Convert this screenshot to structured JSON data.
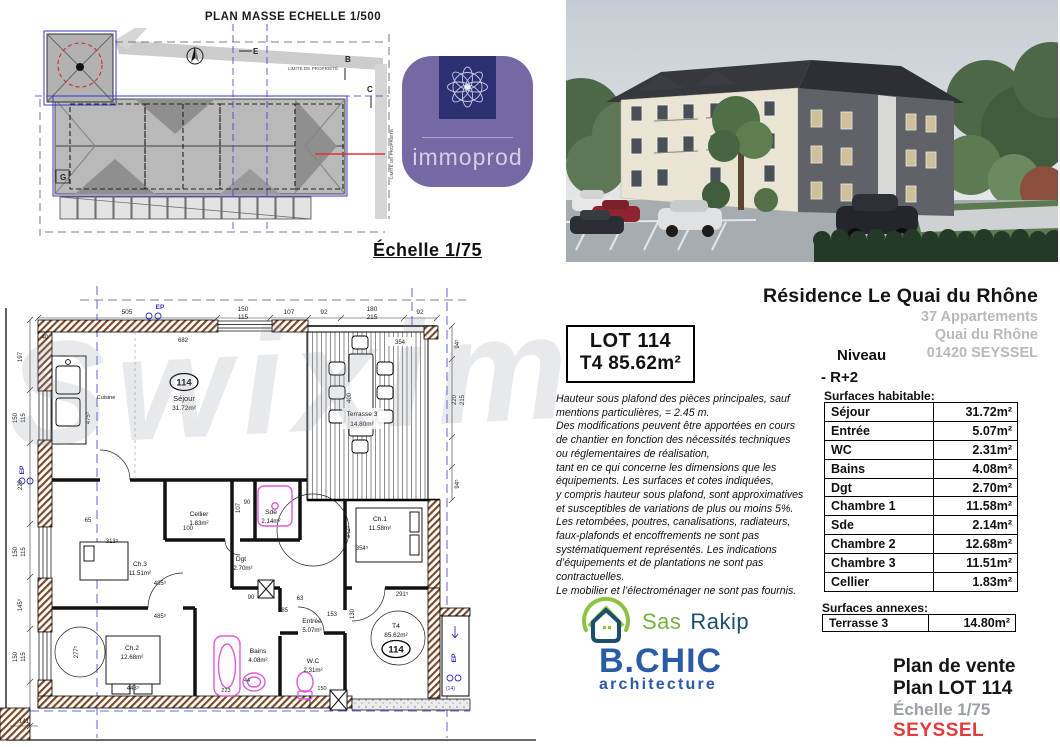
{
  "watermark": "Swixim",
  "site_plan": {
    "title": "PLAN MASSE ECHELLE 1/500",
    "limite_label_1": "LIMITE DE PROPRIÉTÉ",
    "limite_label_2": "LIMITE DE PROPRIÉTÉ",
    "marker_g": "G",
    "marker_e": "E",
    "marker_b": "B",
    "marker_c": "C"
  },
  "scale_label": "Échelle 1/75",
  "immoprod": {
    "name": "immoprod"
  },
  "header": {
    "title": "Résidence Le Quai du Rhône",
    "line1": "37 Appartements",
    "line2": "Quai du Rhône",
    "line3": "01420 SEYSSEL",
    "niveau_label": "Niveau",
    "niveau_value": "- R+2"
  },
  "lot_box": {
    "line1": "LOT 114",
    "line2": "T4 85.62m²"
  },
  "disclaimer": [
    "Hauteur sous plafond des pièces principales, sauf",
    "mentions particulières, = 2.45 m.",
    "Des modifications peuvent être apportées en cours",
    "de chantier en fonction des nécessités techniques",
    "ou réglementaires de réalisation,",
    "tant en ce qui concerne les dimensions que les",
    "équipements. Les surfaces et cotes indiquées,",
    "y compris hauteur sous plafond, sont approximatives",
    "et susceptibles de variations de plus ou moins 5%.",
    "Les retombées, poutres, canalisations, radiateurs,",
    "faux-plafonds et encoffrements ne sont pas",
    "systématiquement représentés. Les indications",
    "d’équipements et de plantations ne sont pas contractuelles.",
    "Le mobilier et l’électroménager ne sont pas fournis."
  ],
  "surfaces_habitable": {
    "label": "Surfaces habitable:",
    "rows": [
      {
        "name": "Séjour",
        "value": "31.72m²"
      },
      {
        "name": "Entrée",
        "value": "5.07m²"
      },
      {
        "name": "WC",
        "value": "2.31m²"
      },
      {
        "name": "Bains",
        "value": "4.08m²"
      },
      {
        "name": "Dgt",
        "value": "2.70m²"
      },
      {
        "name": "Chambre 1",
        "value": "11.58m²"
      },
      {
        "name": "Sde",
        "value": "2.14m²"
      },
      {
        "name": "Chambre 2",
        "value": "12.68m²"
      },
      {
        "name": "Chambre 3",
        "value": "11.51m²"
      },
      {
        "name": "Cellier",
        "value": "1.83m²"
      }
    ]
  },
  "surfaces_annexes": {
    "label": "Surfaces annexes:",
    "rows": [
      {
        "name": "Terrasse 3",
        "value": "14.80m²"
      }
    ]
  },
  "sale_block": {
    "line1": "Plan de vente",
    "line2": "Plan LOT 114",
    "line3": "Échelle 1/75",
    "line4": "SEYSSEL"
  },
  "partners": {
    "rakip_part1": "Sas",
    "rakip_part2": "Rakip",
    "bchic_name": "B.CHIC",
    "bchic_sub": "architecture"
  },
  "floorplan": {
    "unit_badge": "114",
    "ep_label": "EP",
    "rooms": {
      "sejour": {
        "name": "Séjour",
        "area": "31.72m²"
      },
      "cuisine": {
        "name": "Cuisine"
      },
      "terrasse": {
        "name": "Terrasse 3",
        "area": "14.80m²"
      },
      "cellier": {
        "name": "Cellier",
        "area": "1.83m²"
      },
      "sde": {
        "name": "Sde",
        "area": "2.14m²"
      },
      "dgt": {
        "name": "Dgt",
        "area": "2.70m²"
      },
      "ch1": {
        "name": "Ch.1",
        "area": "11.58m²"
      },
      "ch2": {
        "name": "Ch.2",
        "area": "12.68m²"
      },
      "ch3": {
        "name": "Ch.3",
        "area": "11.51m²"
      },
      "bains": {
        "name": "Bains",
        "area": "4.08m²"
      },
      "wc": {
        "name": "W.C",
        "area": "2.31m²"
      },
      "entree": {
        "name": "Entrée",
        "area": "5.07m²"
      },
      "t4": {
        "name": "T4",
        "area": "85.62m²"
      }
    },
    "dims_top": [
      "505",
      "150",
      "115",
      "107",
      "92",
      "180",
      "215",
      "92"
    ],
    "dims_left": [
      "197",
      "150",
      "115",
      "229",
      "150",
      "115",
      "145⁵",
      "150",
      "115",
      "141"
    ],
    "dims_right": [
      "94⁵",
      "220",
      "215",
      "94⁵"
    ],
    "dims_inner": [
      "682",
      "40",
      "354",
      "475⁵",
      "400",
      "107",
      "65",
      "100",
      "90",
      "90",
      "313⁵",
      "485⁵",
      "485⁵",
      "443⁵",
      "223",
      "44",
      "150",
      "63",
      "153",
      "285",
      "130",
      "277⁵",
      "342⁵",
      "291⁵",
      "354⁵"
    ]
  },
  "colors": {
    "purple": "#7668a3",
    "navy": "#2b3170",
    "red": "#e03c3e",
    "bchic_blue": "#2b5ba7",
    "rakip_green": "#76b043",
    "rakip_navy": "#1c4f6b",
    "gray_text": "#b9b9b9",
    "plan_blue": "#2e2ebd",
    "fixture_pink": "#e05ad8",
    "wall_brown": "#7a4a28"
  }
}
